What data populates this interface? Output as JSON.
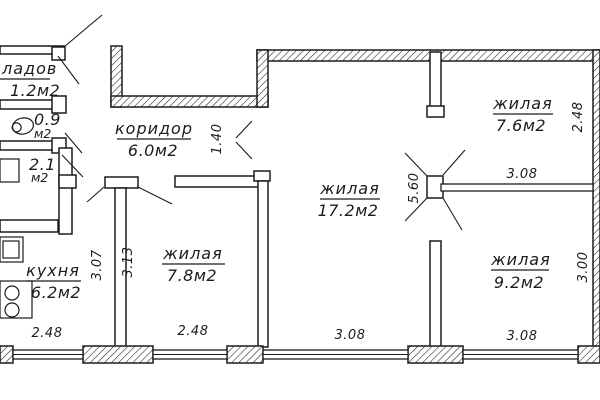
{
  "ink": "#1c1c1c",
  "rooms": {
    "storage": {
      "name": "ладов",
      "area": "1.2м2"
    },
    "toilet": {
      "area": "0.9",
      "unit": "м2"
    },
    "bath": {
      "area": "2.1",
      "unit": "м2"
    },
    "corridor": {
      "name": "коридор",
      "area": "6.0м2"
    },
    "kitchen": {
      "name": "кухня",
      "area": "6.2м2"
    },
    "living_main": {
      "name": "жилая",
      "area": "17.2м2"
    },
    "living_ne": {
      "name": "жилая",
      "area": "7.6м2"
    },
    "living_sw": {
      "name": "жилая",
      "area": "7.8м2"
    },
    "living_se": {
      "name": "жилая",
      "area": "9.2м2"
    }
  },
  "dims": {
    "kitchen_width": "2.48",
    "kitchen_depth": "3.07",
    "living_sw_width": "2.48",
    "living_sw_depth": "3.13",
    "living_main_width": "3.08",
    "living_main_depth": "5.60",
    "living_ne_width": "3.08",
    "living_ne_depth": "2.48",
    "living_se_width": "3.08",
    "living_se_depth": "3.00",
    "corridor_opening": "1.40"
  }
}
